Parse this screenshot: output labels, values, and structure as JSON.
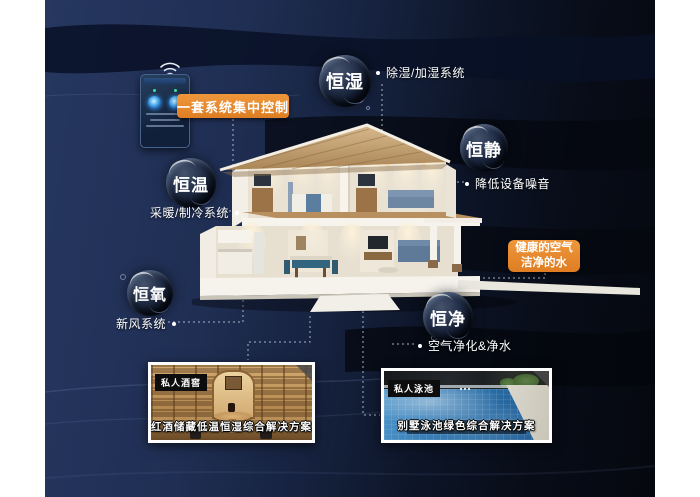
{
  "colors": {
    "accent_orange": "#E5842B",
    "background_navy": "#22335C",
    "background_dark": "#070B15"
  },
  "control": {
    "label": "一套系统集中控制"
  },
  "features": [
    {
      "key": "humidity",
      "bubble": "恒湿",
      "desc": "除湿/加湿系统"
    },
    {
      "key": "quiet",
      "bubble": "恒静",
      "desc": "降低设备噪音"
    },
    {
      "key": "temperature",
      "bubble": "恒温",
      "desc": "采暖/制冷系统"
    },
    {
      "key": "oxygen",
      "bubble": "恒氧",
      "desc": "新风系统"
    },
    {
      "key": "purity",
      "bubble": "恒净",
      "desc": "空气净化&净水"
    }
  ],
  "highlight": {
    "line1": "健康的空气",
    "line2": "洁净的水"
  },
  "cards": [
    {
      "tag": "私人酒窖",
      "caption": "红酒储藏低温恒湿综合解决方案"
    },
    {
      "tag": "私人泳池",
      "caption": "别墅泳池绿色综合解决方案"
    }
  ]
}
